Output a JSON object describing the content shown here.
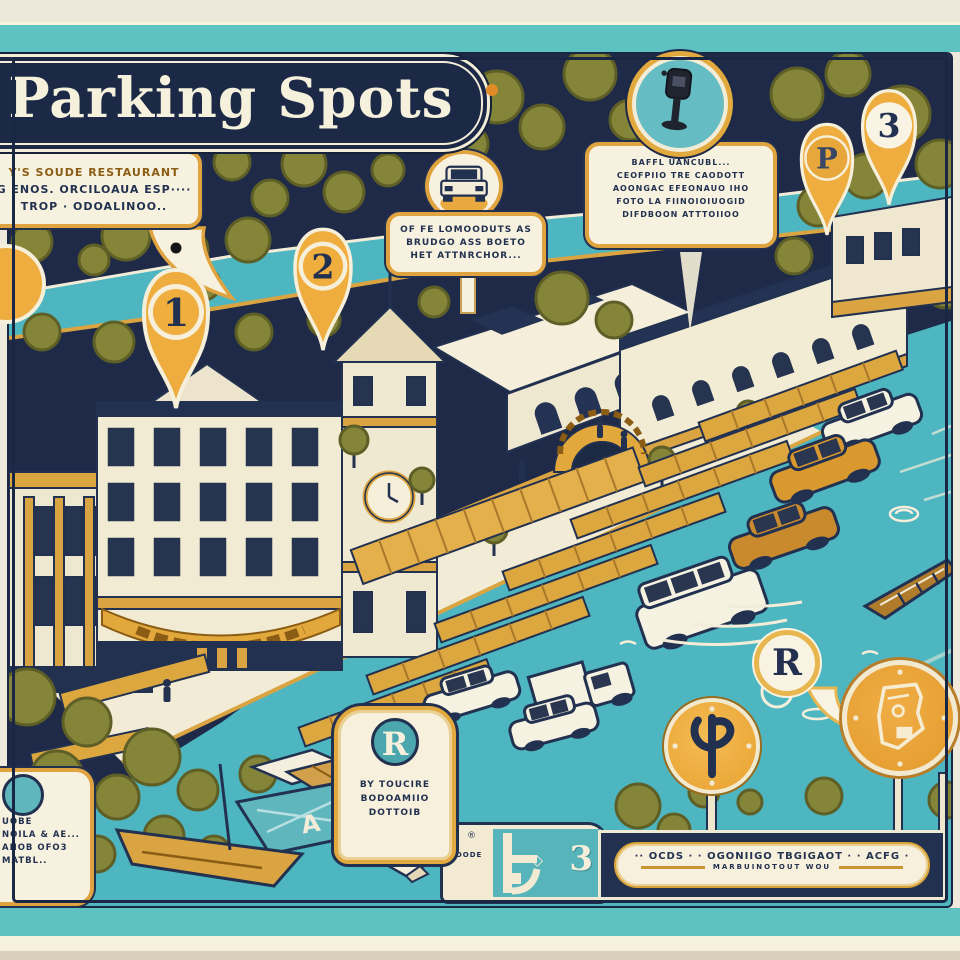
{
  "palette": {
    "teal_band": "#5fc2c2",
    "navy": "#223150",
    "cream": "#f4eeda",
    "gold": "#e8a93f",
    "olive": "#85853a",
    "water": "#4db6c0",
    "amber": "#d9992e"
  },
  "title": {
    "text": "Parking Spots"
  },
  "pins": {
    "pin1": "1",
    "pin2": "2",
    "pin3": "3",
    "pinP": "P"
  },
  "callouts": {
    "restaurant": {
      "line1": "Y'S SOUDE RESTAURANT",
      "line2": "G ENOS. ORCILOAUA ESP····",
      "line3": "TROP · ODOALINOO.."
    },
    "car": {
      "line1": "OF FE LOMOODUTS AS",
      "line2": "BRUDGO ASS BOETO",
      "line3": "HET ATTNRCHOR..."
    },
    "meter": {
      "line1": "BAFFL UANCUBL...",
      "line2": "CEOFPIIO TRE CAODOTT",
      "line3": "AOONGAC EFEONAUO IHO",
      "line4": "FOTO LA FIINOIOIUOGID",
      "line5": "DIFDBOON ATTTOIIOO"
    },
    "bottomLeft": {
      "line1": "UOBE",
      "line2": "NOILA & AE...",
      "line3": "AHOB OFO3",
      "line4": "MATBL.."
    },
    "rSign": {
      "letter": "R",
      "line1": "BY TOUCIRE",
      "line2": "BODOAMIIO",
      "line3": "DOTTOIB"
    },
    "rBubble": {
      "letter": "R"
    }
  },
  "boatTarp": {
    "letter": "A"
  },
  "banner": {
    "line1": "·· OCDS · · OGONIIGO TBGIGAOT · · ACFG ·",
    "line2": "MARBUINOTOUT WOU"
  },
  "minimap": {
    "label": "ODODE",
    "number": "3",
    "reg": "®",
    "diamond": "◇"
  }
}
